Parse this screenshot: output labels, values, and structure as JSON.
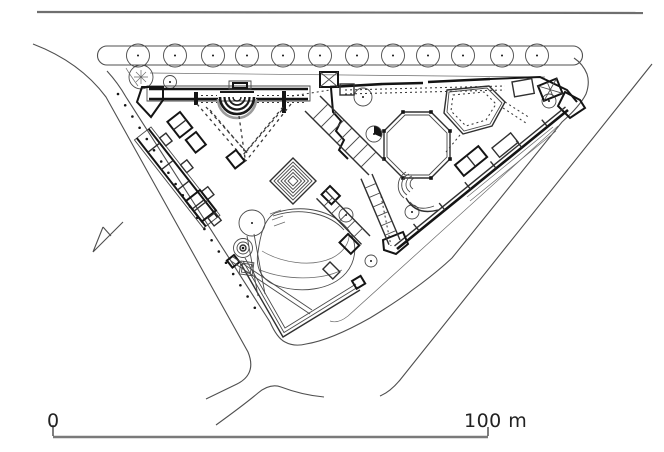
{
  "page": {
    "type_label": "architectural site plan"
  },
  "palette": {
    "background": "#ffffff",
    "ink_dark": "#141414",
    "ink": "#3a3a3a",
    "ink_light": "#6a6a6a",
    "ink_faint": "#8a8a8a"
  },
  "scale_bar": {
    "start_label": "0",
    "end_label": "100 m"
  },
  "vegetation": {
    "median_trees": {
      "y": 55.5,
      "radius": 11.5,
      "xs": [
        138,
        175,
        213,
        247,
        283,
        320,
        357,
        393,
        428,
        463,
        502,
        537
      ]
    },
    "site_trees": [
      {
        "x": 252,
        "y": 223,
        "r": 13
      },
      {
        "x": 363,
        "y": 97,
        "r": 9
      },
      {
        "x": 374,
        "y": 134,
        "r": 8
      },
      {
        "x": 412,
        "y": 212,
        "r": 7
      },
      {
        "x": 346,
        "y": 215,
        "r": 7
      },
      {
        "x": 371,
        "y": 261,
        "r": 6
      },
      {
        "x": 549,
        "y": 101,
        "r": 7
      },
      {
        "x": 170,
        "y": 82,
        "r": 6.5
      }
    ],
    "accent_tree": {
      "x": 141,
      "y": 77,
      "r": 12
    }
  }
}
